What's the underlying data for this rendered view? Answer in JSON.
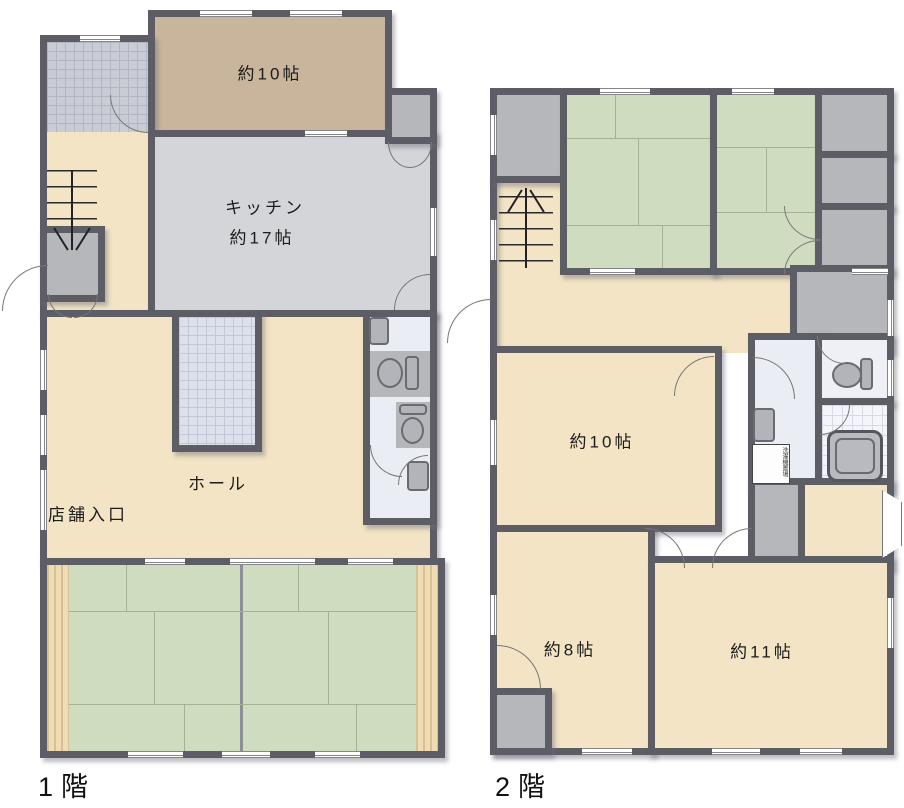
{
  "floor1": {
    "label": "1階",
    "room10": "約10帖",
    "kitchen_line1": "キッチン",
    "kitchen_line2": "約17帖",
    "hall": "ホール",
    "shop_entrance": "店舗入口"
  },
  "floor2": {
    "label": "2階",
    "room10": "約10帖",
    "room8": "約8帖",
    "room11": "約11帖",
    "laundry": "洗濯機置場"
  },
  "palette": {
    "wall": "#5d5d66",
    "floor_cream": "#f2e4c4",
    "floor_tan": "#c9b59b",
    "floor_kitchen_gray": "#d4d5d9",
    "closet_gray": "#b6b7bb",
    "tatami_green": "#cfdcc0",
    "washroom_lavender": "#ebedf5",
    "wood_trim": "#eedcb4"
  }
}
